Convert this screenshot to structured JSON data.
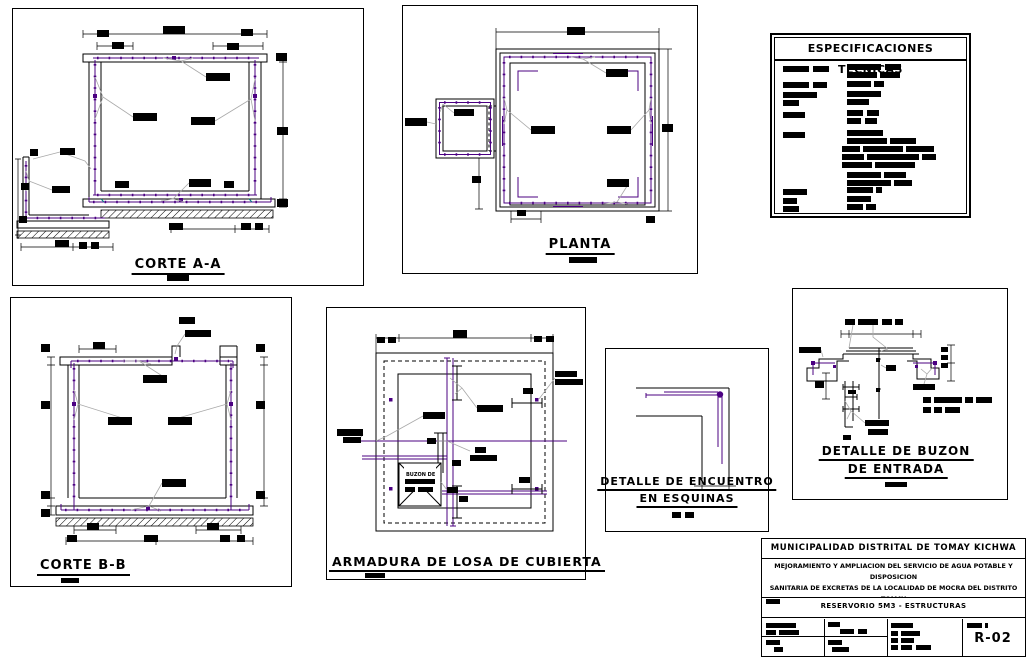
{
  "colors": {
    "rebar": "#4b0082",
    "leader": "#a9a9a9",
    "teal": "#008080",
    "line": "#000000",
    "background": "#ffffff"
  },
  "panels": {
    "corte_aa": {
      "title": "CORTE A-A"
    },
    "planta": {
      "title": "PLANTA"
    },
    "especificaciones": {
      "title": "ESPECIFICACIONES TECNICAS"
    },
    "corte_bb": {
      "title": "CORTE B-B"
    },
    "armadura": {
      "title": "ARMADURA DE LOSA DE CUBIERTA",
      "buzon_label": "BUZON DE"
    },
    "encuentro": {
      "title_line1": "DETALLE DE ENCUENTRO",
      "title_line2": "EN ESQUINAS"
    },
    "buzon": {
      "title_line1": "DETALLE DE BUZON",
      "title_line2": "DE ENTRADA"
    }
  },
  "title_block": {
    "municipality": "MUNICIPALIDAD DISTRITAL DE TOMAY KICHWA",
    "project_line1": "MEJORAMIENTO Y AMPLIACION  DEL SERVICIO DE AGUA POTABLE Y DISPOSICION",
    "project_line2": "SANITARIA DE EXCRETAS DE LA LOCALIDAD DE MOCRA DEL DISTRITO TOMAY",
    "project_line3": "KICHWA, PROVINCIA AMBO  - REGION HUANUCO",
    "plan_name": "RESERVORIO 5M3 - ESTRUCTURAS",
    "sheet_number": "R-02"
  }
}
